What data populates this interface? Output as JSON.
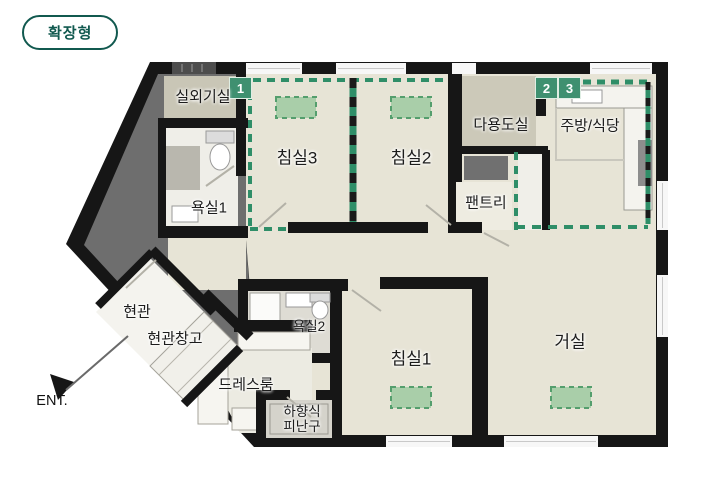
{
  "plan_type_badge": "확장형",
  "entrance": {
    "label": "ENT."
  },
  "markers": {
    "m1": "1",
    "m2": "2",
    "m3": "3"
  },
  "rooms": {
    "outdoor_unit": "실외기실",
    "bedroom3": "침실3",
    "bedroom2": "침실2",
    "utility": "다용도실",
    "kitchen": "주방/식당",
    "pantry": "팬트리",
    "bath1": "욕실1",
    "entry": "현관",
    "entry_storage": "현관창고",
    "dressroom": "드레스룸",
    "bath2": "욕실2",
    "bedroom1": "침실1",
    "living": "거실"
  },
  "evac": {
    "line1": "하향식",
    "line2": "피난구"
  },
  "colors": {
    "wall": "#161616",
    "floor": "#e7e4d6",
    "core_gray": "#6e6e6e",
    "expansion_green": "#2f8e68",
    "ac_unit_green": "#a9cea9",
    "marker_bg": "#3f9070",
    "badge_teal": "#11594f"
  }
}
